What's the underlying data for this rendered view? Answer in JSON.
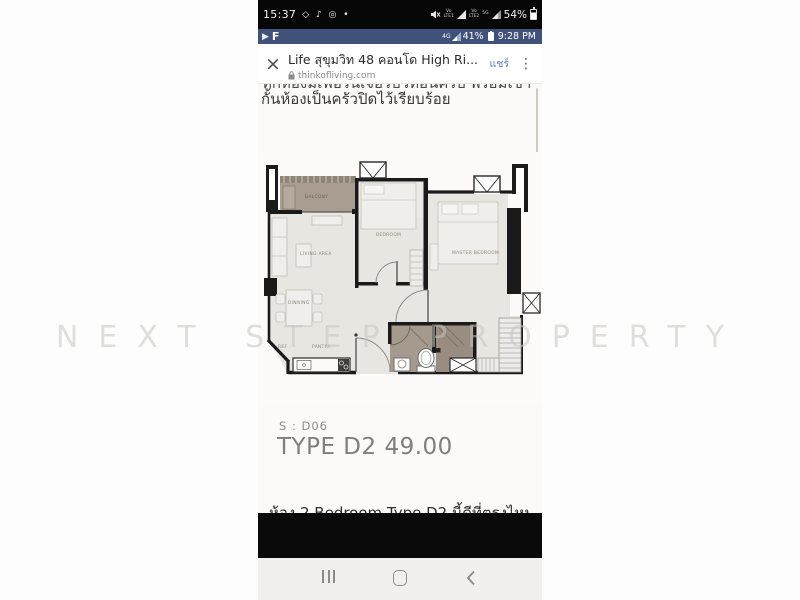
{
  "status_bar": {
    "time": "15:37",
    "icon_glyphs": "◇ ♪ ◎ •",
    "net1": "Vo\nLTE1",
    "net2": "Vo\nLTE2",
    "net5g": "5G",
    "battery": "54%"
  },
  "secondary_bar": {
    "network": "4G",
    "battery": "41%",
    "time": "9:28 PM"
  },
  "browser": {
    "close_glyph": "×",
    "title": "Life สุขุมวิท 48 คอนโด High Ri...",
    "url": "thinkofliving.com",
    "share_label": "แชร์",
    "menu_glyph": "⋮",
    "accent_color": "#5b7cc0",
    "bar_color": "#41527a"
  },
  "page": {
    "clipped_top_line": "ทุกห้องมีเฟอร์นิเจอร์บิวท์อินครบ พร้อมเข้าอยู่ได้เลย",
    "paragraph": "กั้นห้องเป็นครัวปิดไว้เรียบร้อย",
    "unit_code": "S : D06",
    "unit_type": "TYPE D2 49.00",
    "clipped_bottom_line": "ห้อง 2 Bedroom Type D2 นี้ดีที่ตรงไหน",
    "watermark": "NEXT STEP PROPERTY"
  },
  "floorplan": {
    "labels": {
      "balcony": "BALCONY",
      "bedroom": "BEDROOM",
      "master_bedroom": "MASTER BEDROOM",
      "living": "LIVING AREA",
      "dinning": "DINNING",
      "ref": "REF",
      "pantry": "PANTRY"
    },
    "colors": {
      "wall": "#1a1a1a",
      "floor": "#e8e6e1",
      "balcony": "#a89d90",
      "bathroom": "#a59a8d",
      "bathroom_dark": "#988d80",
      "furniture": "#f0eeea"
    }
  }
}
